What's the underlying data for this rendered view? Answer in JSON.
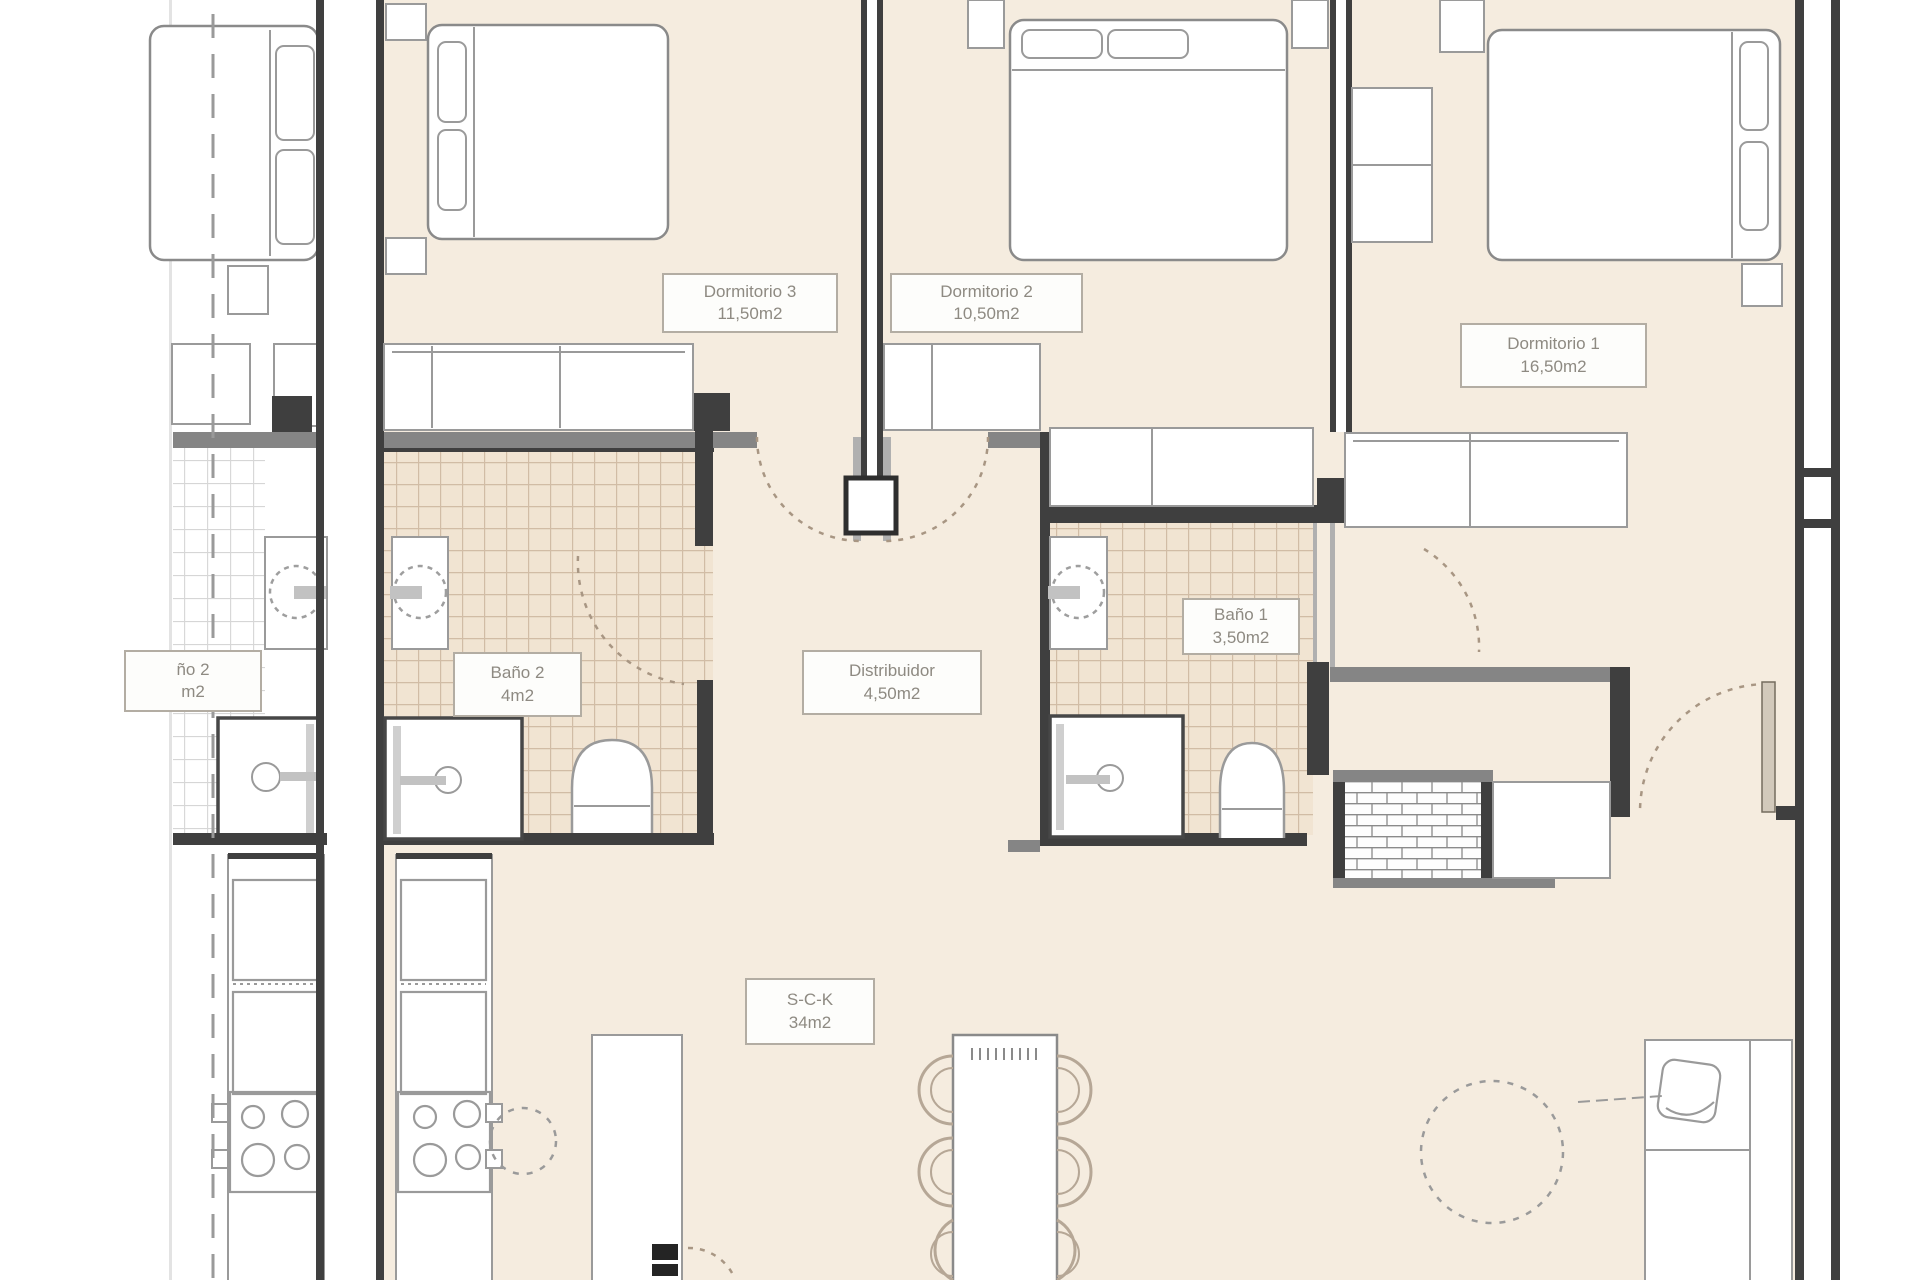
{
  "plan": {
    "type": "apartment floor plan",
    "units": "m2"
  },
  "rooms": {
    "dormitorio3": {
      "name": "Dormitorio 3",
      "area": "11,50m2"
    },
    "dormitorio2": {
      "name": "Dormitorio 2",
      "area": "10,50m2"
    },
    "dormitorio1": {
      "name": "Dormitorio 1",
      "area": "16,50m2"
    },
    "bano2": {
      "name": "Baño 2",
      "area": "4m2"
    },
    "bano1": {
      "name": "Baño 1",
      "area": "3,50m2"
    },
    "distribuidor": {
      "name": "Distribuidor",
      "area": "4,50m2"
    },
    "sck": {
      "name": "S-C-K",
      "area": "34m2"
    },
    "neighbor_bano_partial": {
      "name": "ño 2",
      "area": "m2"
    }
  },
  "colors": {
    "floor": "#f5ecdf",
    "tile": "#f1e4d2",
    "wall_dark": "#3f3f3f",
    "wall_mid": "#858585",
    "furniture_stroke": "#9a9a9a",
    "label_border": "#b3ada3",
    "label_text": "#8e8a82",
    "dash": "#a89683",
    "boundary": "#9a9a9a"
  }
}
